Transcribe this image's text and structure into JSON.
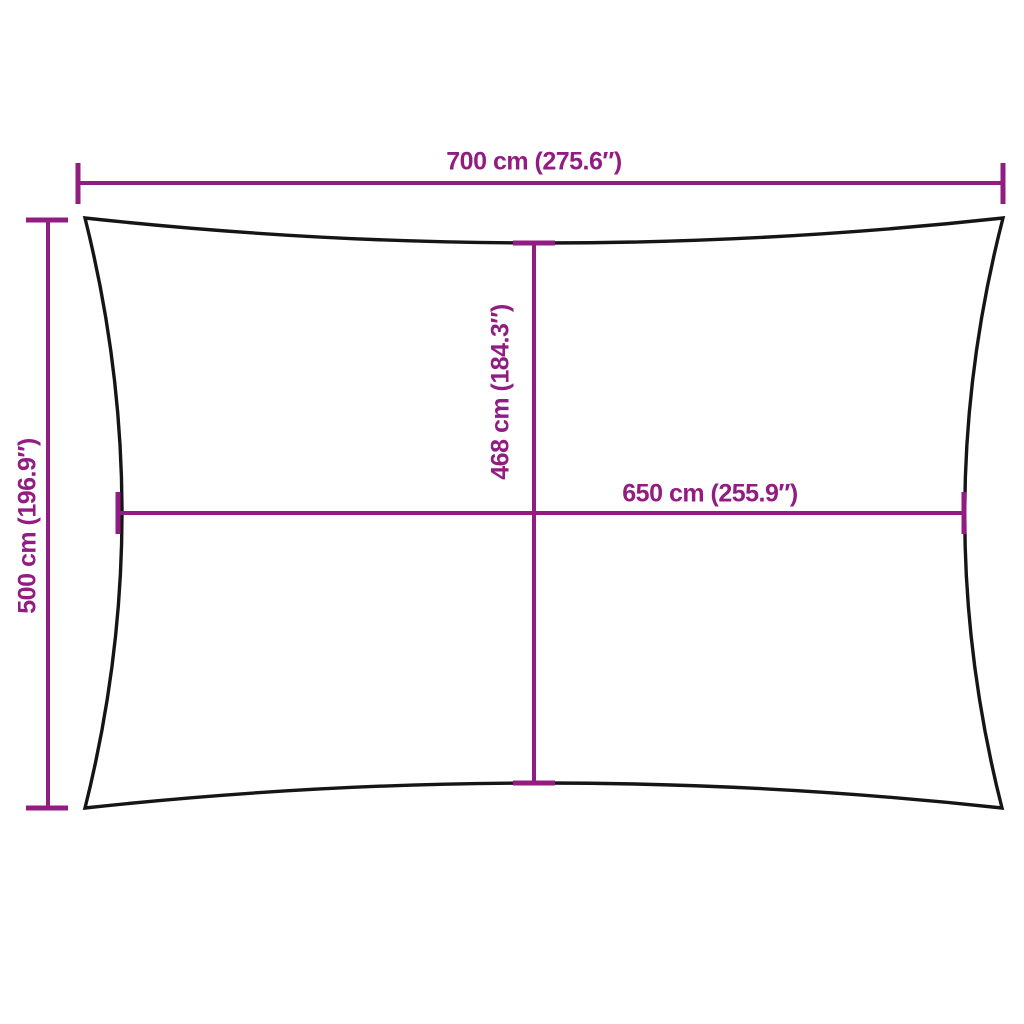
{
  "colors": {
    "background": "#ffffff",
    "dimension_lines": "#911c82",
    "sail_outline": "#151515",
    "sail_fill": "#ffffff"
  },
  "measurements": {
    "top_width": {
      "cm": "700",
      "inches": "275.6",
      "label": "700 cm (275.6″)"
    },
    "left_height": {
      "cm": "500",
      "inches": "196.9",
      "label": "500 cm (196.9″)"
    },
    "center_height": {
      "cm": "468",
      "inches": "184.3",
      "label": "468 cm (184.3″)"
    },
    "center_width": {
      "cm": "650",
      "inches": "255.9",
      "label": "650 cm (255.9″)"
    }
  }
}
